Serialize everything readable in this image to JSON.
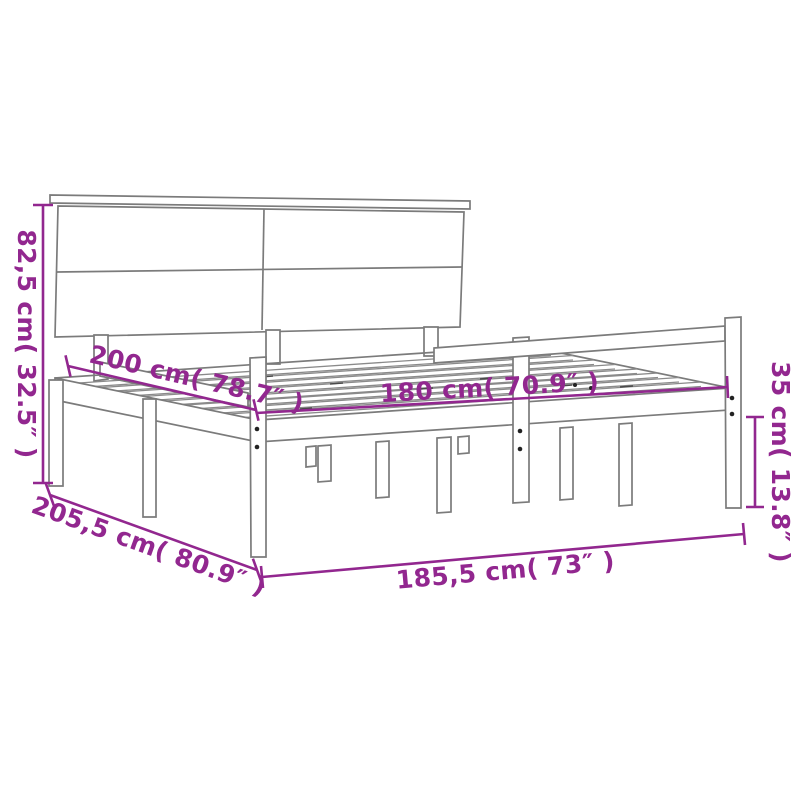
{
  "page": {
    "background": "#ffffff",
    "description": "Product dimension diagram of a wooden bed frame with headboard and side rails"
  },
  "diagram": {
    "product_name": "Bed frame with headboard and side rails",
    "style": {
      "dimension_color": "#92278F",
      "outline_color": "#7b7b7b",
      "background": "#ffffff"
    },
    "dimensions": [
      {
        "id": "headboard-height",
        "label": "82,5 cm( 32.5″ )",
        "cm": "82,5",
        "inches": "32.5",
        "placement": "left-vertical"
      },
      {
        "id": "bed-length",
        "label": "200 cm( 78.7″ )",
        "cm": "200",
        "inches": "78.7",
        "placement": "upper-left-diagonal"
      },
      {
        "id": "slat-base-width",
        "label": "180 cm( 70.9″ )",
        "cm": "180",
        "inches": "70.9",
        "placement": "center-horizontal"
      },
      {
        "id": "side-rail-height",
        "label": "35 cm( 13.8″ )",
        "cm": "35",
        "inches": "13.8",
        "placement": "right-vertical"
      },
      {
        "id": "overall-length",
        "label": "205,5 cm( 80.9″ )",
        "cm": "205,5",
        "inches": "80.9",
        "placement": "lower-left-diagonal"
      },
      {
        "id": "overall-width",
        "label": "185,5 cm( 73″ )",
        "cm": "185,5",
        "inches": "73",
        "placement": "bottom-horizontal"
      }
    ],
    "parts": {
      "headboard": "two-by-two panel headboard with top cap",
      "base": "slatted bed base",
      "rails": "side safety rails with posts",
      "legs": "wooden legs"
    }
  }
}
